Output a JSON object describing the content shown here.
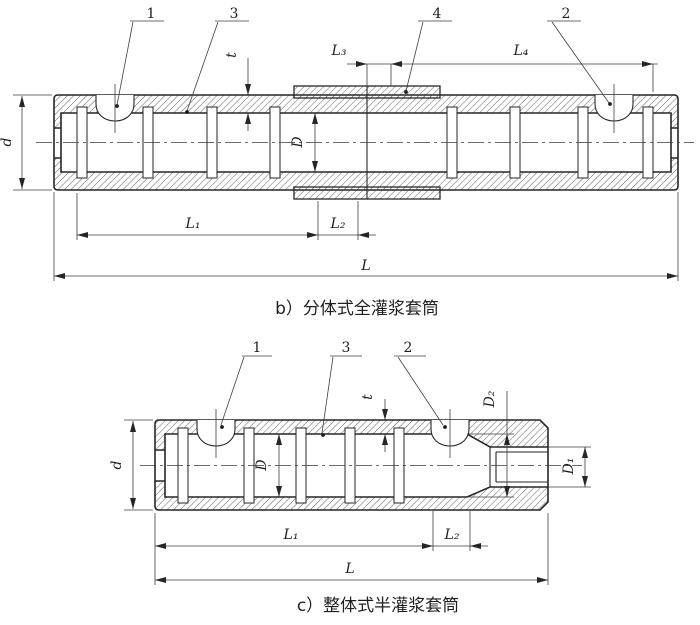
{
  "figure_b": {
    "caption": "b）分体式全灌浆套筒",
    "callouts": {
      "c1": "1",
      "c3": "3",
      "c4": "4",
      "c2": "2"
    },
    "dims": {
      "d": "d",
      "t": "t",
      "L3": "L₃",
      "L4": "L₄",
      "D": "D",
      "L1": "L₁",
      "L2": "L₂",
      "L": "L"
    }
  },
  "figure_c": {
    "caption": "c）整体式半灌浆套筒",
    "callouts": {
      "c1": "1",
      "c3": "3",
      "c2": "2"
    },
    "dims": {
      "d": "d",
      "t": "t",
      "D": "D",
      "D2": "D₂",
      "D1": "D₁",
      "L1": "L₁",
      "L2": "L₂",
      "L": "L"
    }
  },
  "colors": {
    "line": "#262626",
    "background": "#ffffff",
    "hatch": "#4a4a4a"
  }
}
